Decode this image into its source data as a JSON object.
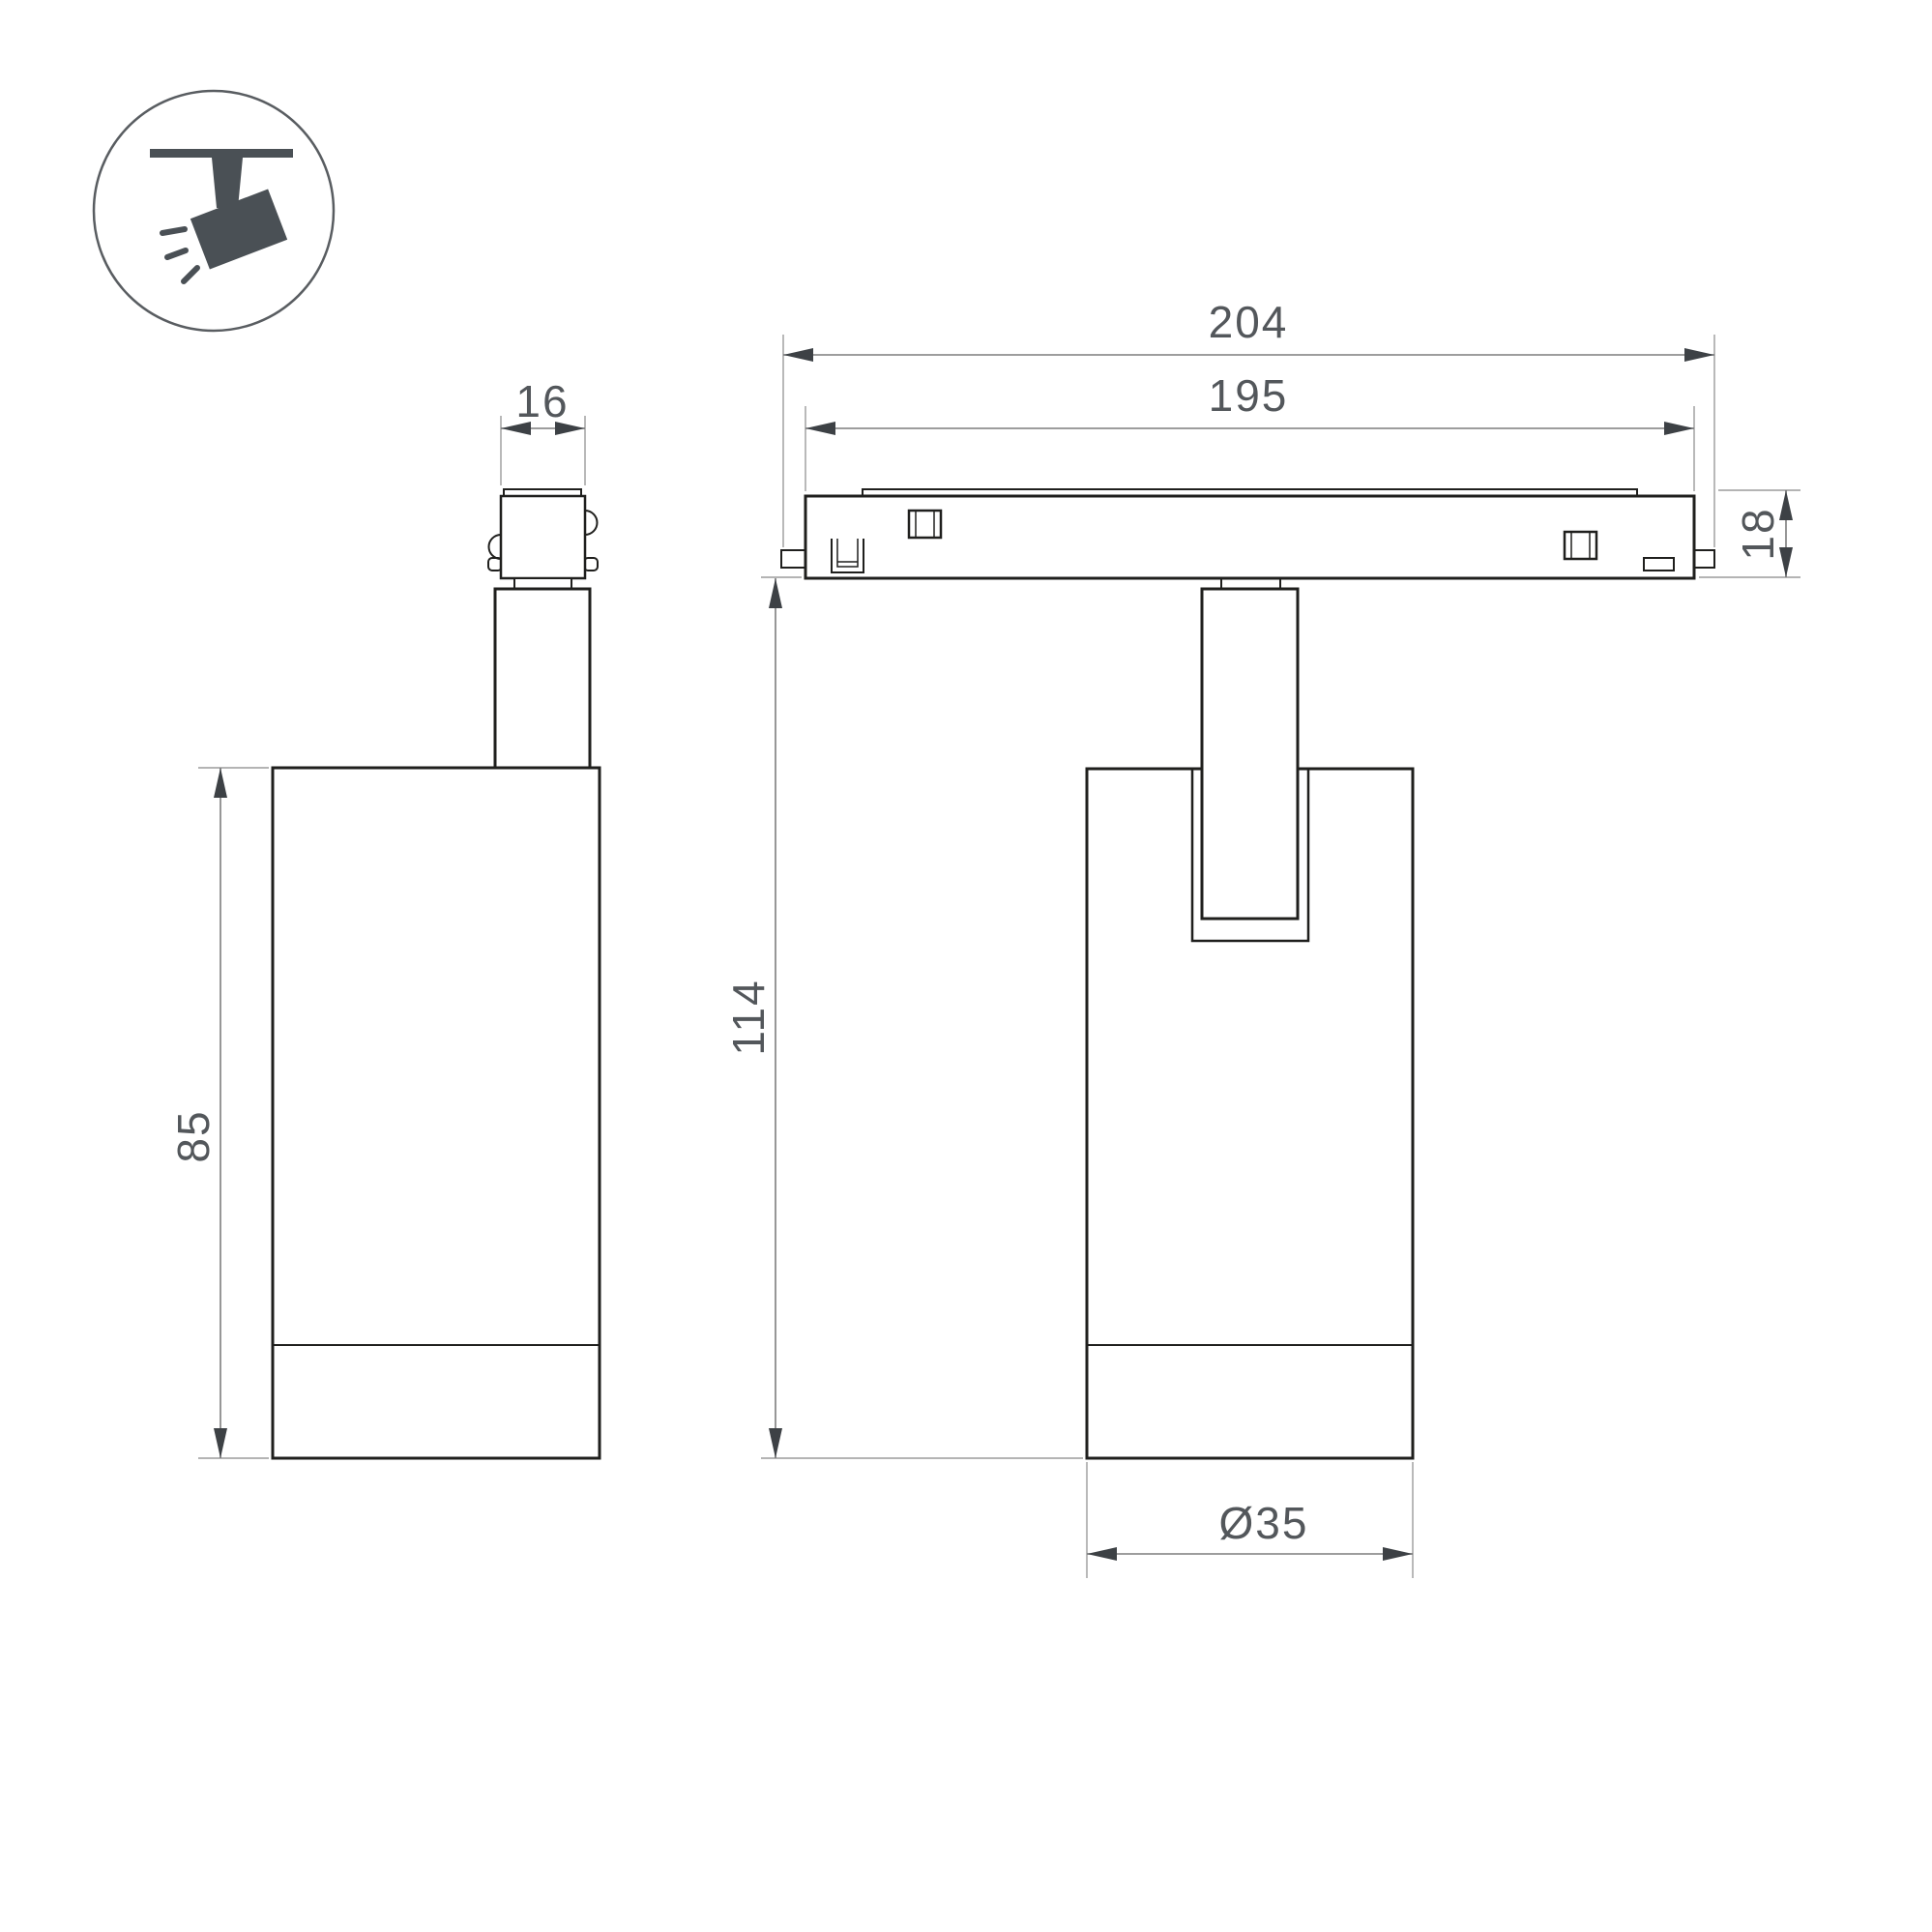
{
  "labels": {
    "track_outer_length": "204",
    "track_body_length": "195",
    "adapter_width": "16",
    "track_height": "18",
    "body_height": "85",
    "overall_height": "114",
    "body_diameter": "Ø35"
  },
  "colors": {
    "background": "#ffffff",
    "outline": "#1f1f1d",
    "dimension_line": "#7d7d7d",
    "extension_line": "#9b9b9b",
    "arrowhead": "#3d4145",
    "dimension_text": "#53575b",
    "icon": "#4a5055"
  },
  "icon": {
    "name": "ceiling-track-spotlight-icon"
  }
}
